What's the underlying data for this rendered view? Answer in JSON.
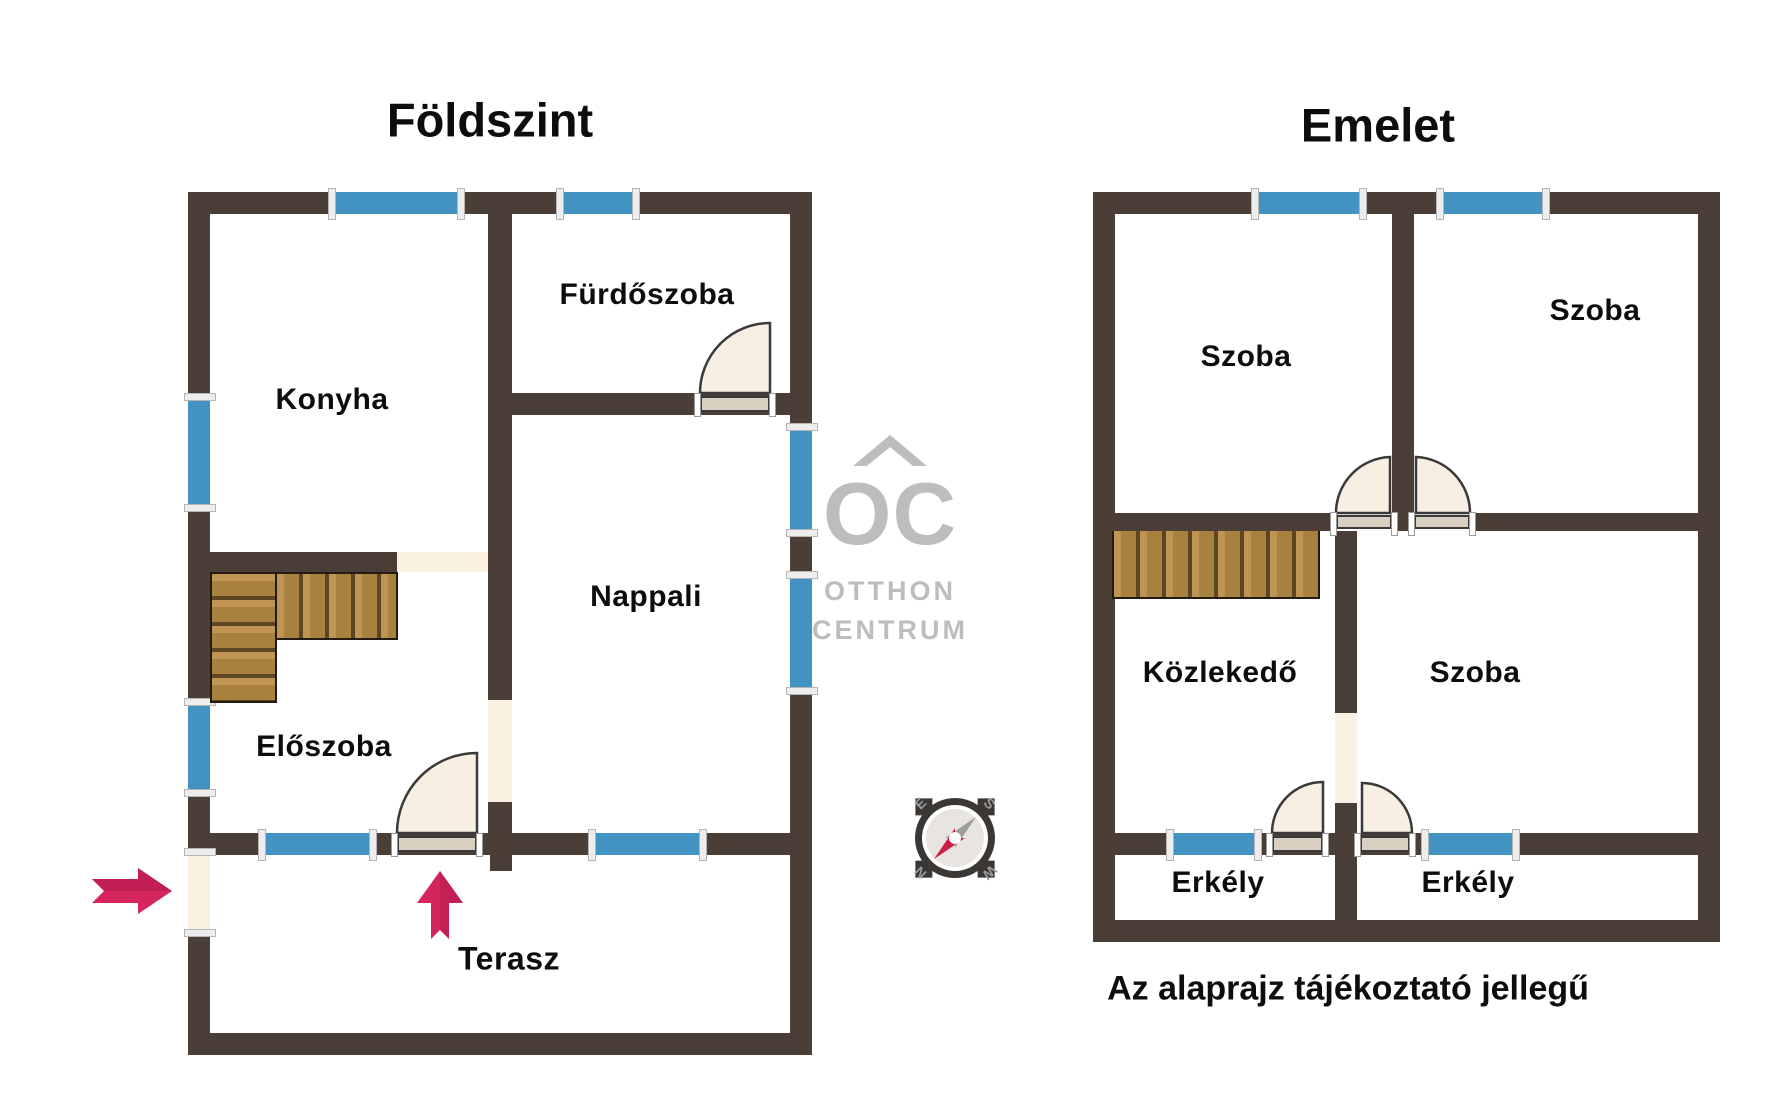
{
  "floors": {
    "ground": {
      "title": "Földszint",
      "rooms": {
        "konyha": "Konyha",
        "furdoszoba": "Fürdőszoba",
        "nappali": "Nappali",
        "eloszoba": "Előszoba",
        "terasz": "Terasz"
      }
    },
    "upper": {
      "title": "Emelet",
      "rooms": {
        "szoba_top_left": "Szoba",
        "szoba_top_right": "Szoba",
        "kozlekedo": "Közlekedő",
        "szoba_bottom_right": "Szoba",
        "erkely_left": "Erkély",
        "erkely_right": "Erkély"
      }
    }
  },
  "caption": "Az alaprajz tájékoztató jellegű",
  "logo": {
    "monogram": "OC",
    "line1": "OTTHON",
    "line2": "CENTRUM"
  },
  "compass": {
    "north": "N",
    "east": "E",
    "south": "S",
    "west": "W"
  },
  "colors": {
    "wall": "#4a3e36",
    "window": "#4292c2",
    "opening": "#faf1e3",
    "door_fill": "#f7efe2",
    "door_leaf": "#d9cfc0",
    "door_stroke": "#3a3a3a",
    "wood_light": "#c09452",
    "wood_mid": "#a8813f",
    "wood_dark": "#5d4722",
    "arrow": "#d4255c",
    "arrow_dark": "#b01c4e",
    "logo": "#bdbdbd",
    "compass_dark": "#3a3734",
    "compass_letter": "#9b9b9b",
    "needle_red": "#cc1f47",
    "needle_gray": "#9e9e9e",
    "text": "#0d0d0d"
  }
}
